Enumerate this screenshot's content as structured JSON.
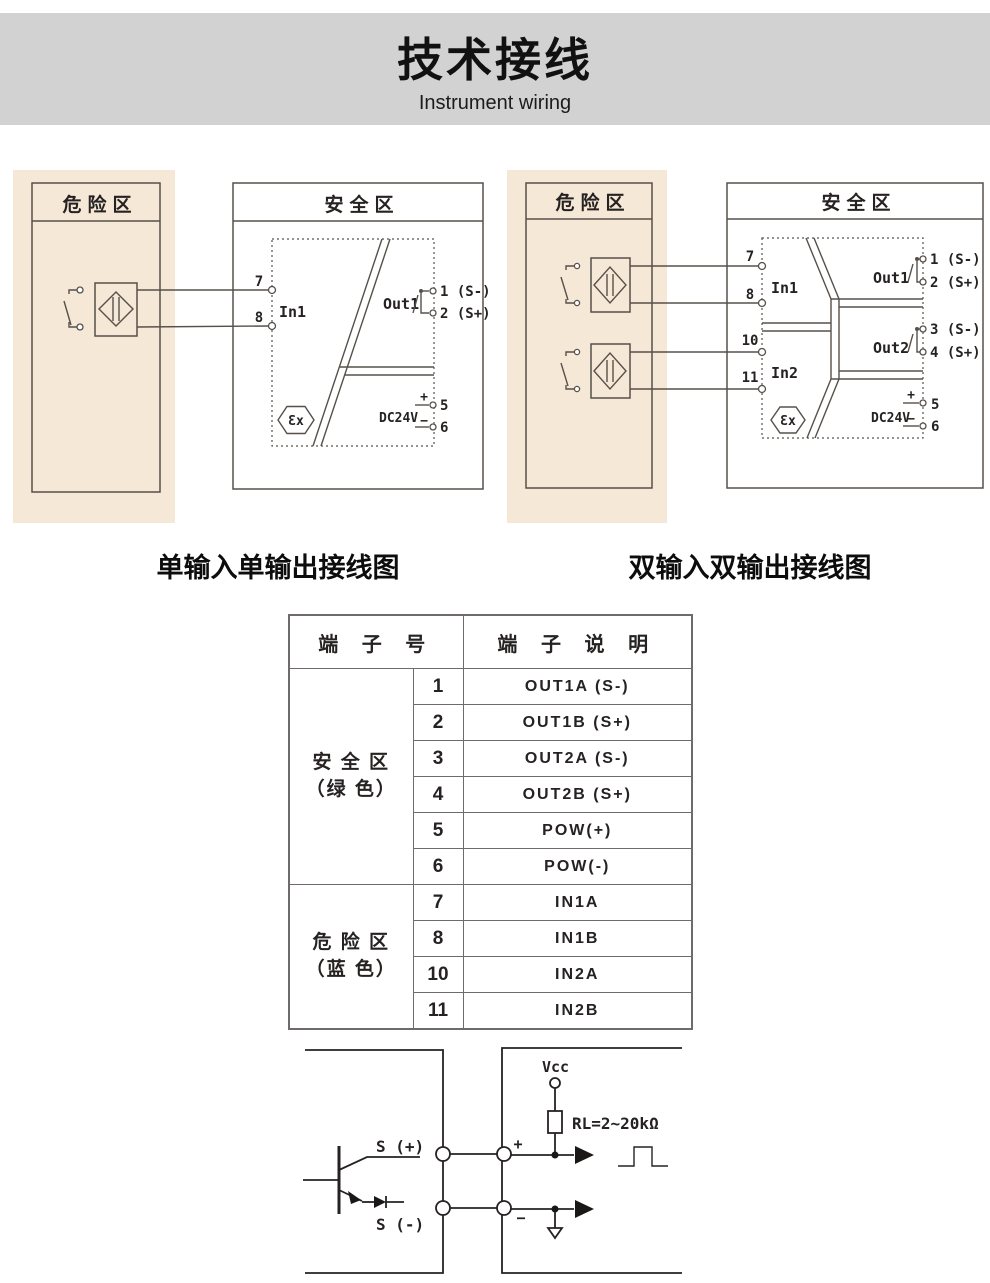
{
  "header": {
    "title": "技术接线",
    "subtitle": "Instrument wiring"
  },
  "diagram_left": {
    "caption": "单输入单输出接线图",
    "hazard_zone": "危险区",
    "safe_zone": "安全区",
    "t7": "7",
    "t8": "8",
    "in1": "In1",
    "out1": "Out1",
    "out1_a": "1 (S-)",
    "out1_b": "2 (S+)",
    "ex": "Ɛx",
    "dc": "DC24V",
    "plus": "+",
    "minus": "−",
    "t5": "5",
    "t6": "6"
  },
  "diagram_right": {
    "caption": "双输入双输出接线图",
    "hazard_zone": "危险区",
    "safe_zone": "安全区",
    "t7": "7",
    "t8": "8",
    "t10": "10",
    "t11": "11",
    "in1": "In1",
    "in2": "In2",
    "out1": "Out1",
    "out1_a": "1 (S-)",
    "out1_b": "2 (S+)",
    "out2": "Out2",
    "out2_a": "3 (S-)",
    "out2_b": "4 (S+)",
    "ex": "Ɛx",
    "dc": "DC24V",
    "plus": "+",
    "minus": "−",
    "t5": "5",
    "t6": "6"
  },
  "table": {
    "headers": {
      "terminal_no": "端 子 号",
      "terminal_desc": "端 子 说 明"
    },
    "groups": [
      {
        "zone_line1": "安 全 区",
        "zone_line2": "（绿 色）",
        "rows": [
          {
            "no": "1",
            "desc": "OUT1A (S-)"
          },
          {
            "no": "2",
            "desc": "OUT1B (S+)"
          },
          {
            "no": "3",
            "desc": "OUT2A (S-)"
          },
          {
            "no": "4",
            "desc": "OUT2B (S+)"
          },
          {
            "no": "5",
            "desc": "POW(+)"
          },
          {
            "no": "6",
            "desc": "POW(-)"
          }
        ]
      },
      {
        "zone_line1": "危 险 区",
        "zone_line2": "（蓝 色）",
        "rows": [
          {
            "no": "7",
            "desc": "IN1A"
          },
          {
            "no": "8",
            "desc": "IN1B"
          },
          {
            "no": "10",
            "desc": "IN2A"
          },
          {
            "no": "11",
            "desc": "IN2B"
          }
        ]
      }
    ]
  },
  "circuit": {
    "s_plus": "S (+)",
    "s_minus": "S (-)",
    "vcc": "Vcc",
    "load": "RL=2~20kΩ",
    "plus": "+",
    "minus": "−"
  },
  "colors": {
    "beige": "#f6e8d7",
    "band_gray": "#d2d2d2",
    "line": "#57504a",
    "table_line": "#6f6b6b",
    "text": "#262222"
  }
}
